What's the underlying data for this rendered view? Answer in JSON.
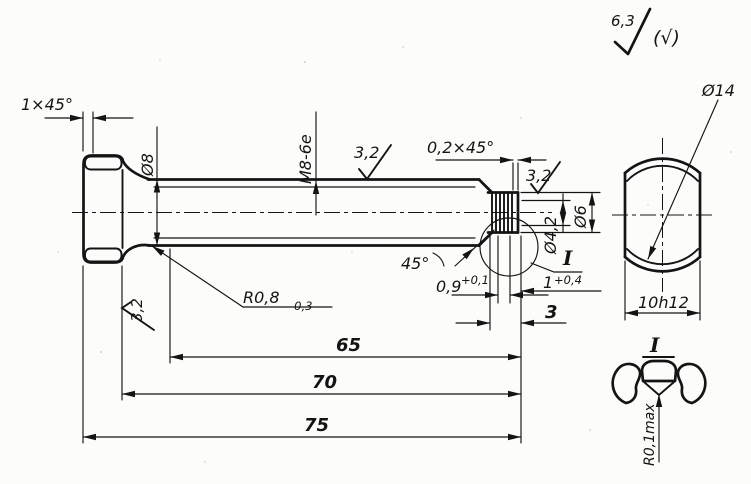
{
  "finish_note": {
    "value": "6,3",
    "collective": "(√)"
  },
  "main_view": {
    "head_chamfer": "1×45°",
    "shank_diameter": "Ø8",
    "thread_spec": "M8-6e",
    "shaft_roughness": "3,2",
    "head_roughness": "3,2",
    "tip_chamfer": "0,2×45°",
    "tip_roughness": "3,2",
    "groove_diameter": "Ø4,2",
    "tip_diameter": "Ø6",
    "chamfer_angle": "45°",
    "groove_width": "0,9",
    "groove_width_tol": "+0,1",
    "land_width": "1",
    "land_width_tol": "+0,4",
    "tip_length": "3",
    "fillet_radius": "R0,8",
    "fillet_radius_tol": "-0,3",
    "thread_length": "65",
    "shank_length": "70",
    "total_length": "75",
    "detail_ref": "I"
  },
  "end_view": {
    "head_diameter": "Ø14",
    "across_flats": "10h12"
  },
  "detail_view": {
    "label": "I",
    "groove_root_radius": "R0,1max"
  }
}
